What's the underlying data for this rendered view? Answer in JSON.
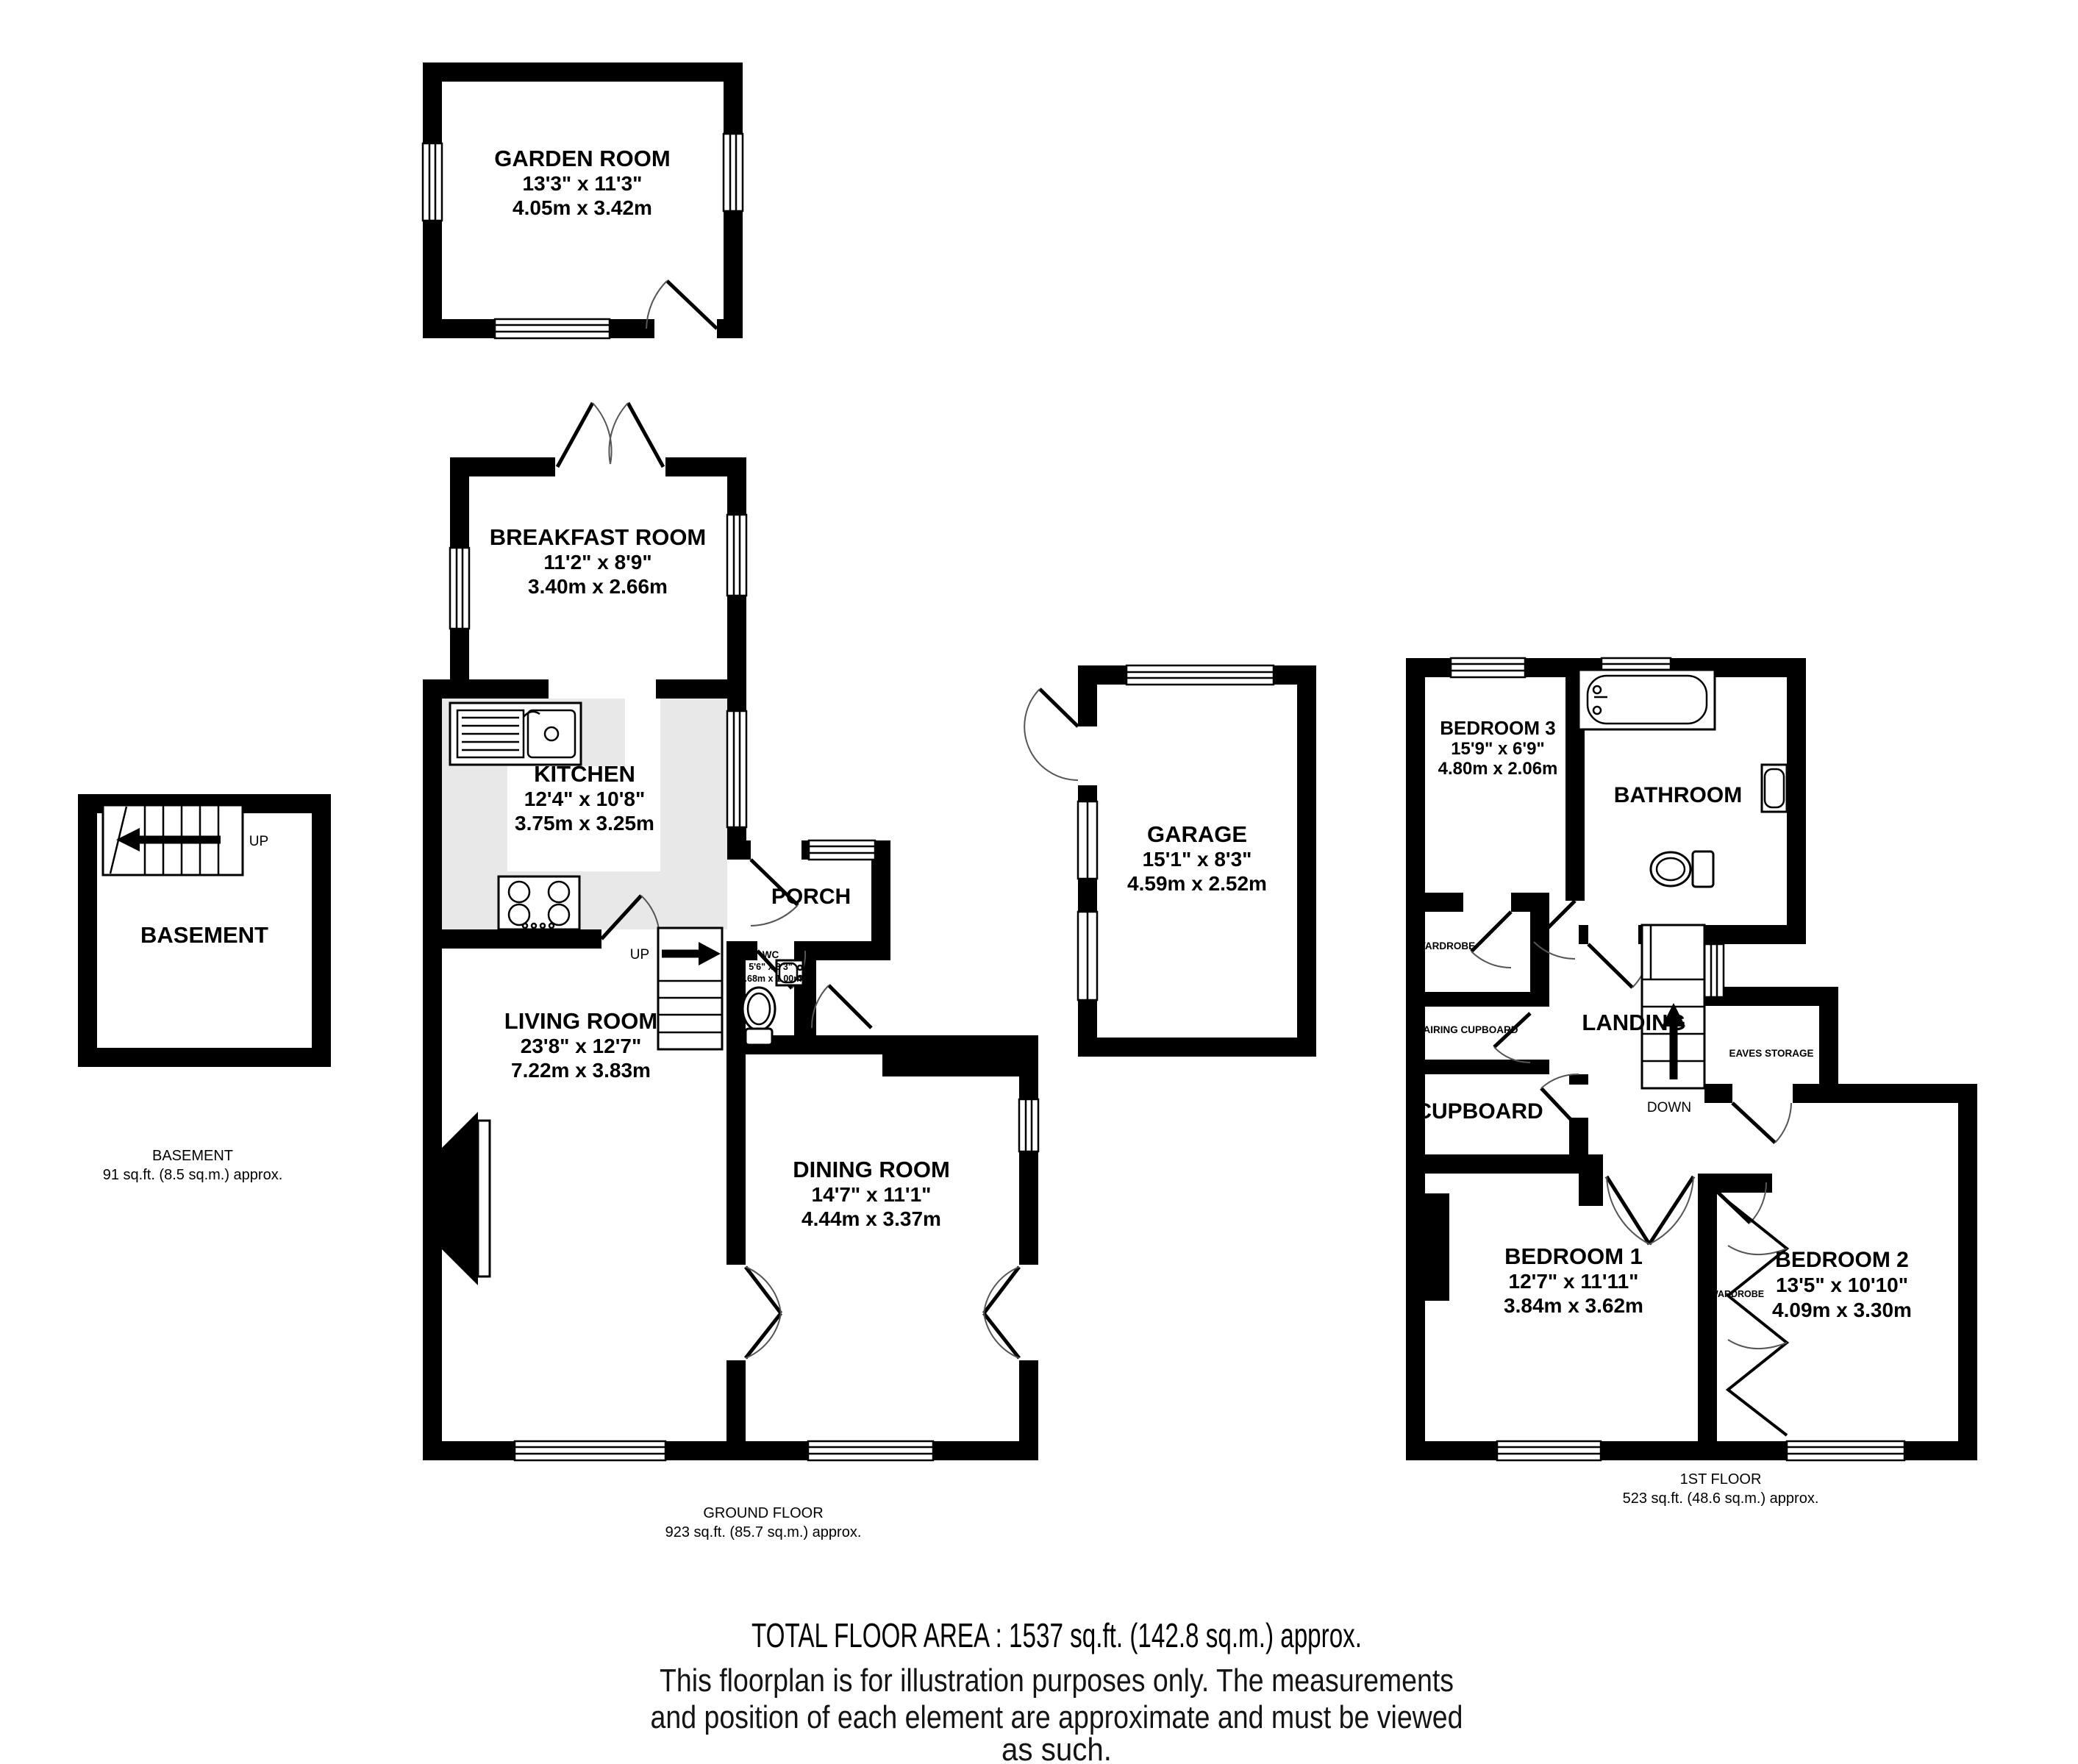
{
  "colors": {
    "wall": "#000000",
    "counter": "#e8e8e8",
    "background": "#ffffff"
  },
  "rooms": {
    "garden_room": {
      "name": "GARDEN ROOM",
      "imperial": "13'3\"  x 11'3\"",
      "metric": "4.05m  x 3.42m"
    },
    "breakfast_room": {
      "name": "BREAKFAST ROOM",
      "imperial": "11'2\"  x 8'9\"",
      "metric": "3.40m  x 2.66m"
    },
    "kitchen": {
      "name": "KITCHEN",
      "imperial": "12'4\"  x 10'8\"",
      "metric": "3.75m  x 3.25m"
    },
    "porch": {
      "name": "PORCH"
    },
    "wc": {
      "name": "WC",
      "imperial": "5'6\"  x 3'3\"",
      "metric": "1.68m  x 1.00m"
    },
    "living_room": {
      "name": "LIVING ROOM",
      "imperial": "23'8\"  x 12'7\"",
      "metric": "7.22m  x 3.83m"
    },
    "dining_room": {
      "name": "DINING ROOM",
      "imperial": "14'7\"  x 11'1\"",
      "metric": "4.44m  x 3.37m"
    },
    "garage": {
      "name": "GARAGE",
      "imperial": "15'1\"  x 8'3\"",
      "metric": "4.59m  x 2.52m"
    },
    "basement": {
      "name": "BASEMENT"
    },
    "bedroom1": {
      "name": "BEDROOM 1",
      "imperial": "12'7\"  x 11'11\"",
      "metric": "3.84m  x 3.62m"
    },
    "bedroom2": {
      "name": "BEDROOM 2",
      "imperial": "13'5\"  x 10'10\"",
      "metric": "4.09m  x 3.30m"
    },
    "bedroom3": {
      "name": "BEDROOM 3",
      "imperial": "15'9\"  x 6'9\"",
      "metric": "4.80m  x 2.06m"
    },
    "bathroom": {
      "name": "BATHROOM"
    },
    "landing": {
      "name": "LANDING"
    },
    "cupboard": {
      "name": "CUPBOARD"
    },
    "airing_cupboard": {
      "name": "AIRING CUPBOARD"
    },
    "wardrobe_bed3": {
      "name": "WARDROBE"
    },
    "wardrobe_bed2": {
      "name": "WARDROBE"
    },
    "eaves_storage": {
      "name": "EAVES STORAGE"
    }
  },
  "stairs": {
    "ground_up": "UP",
    "basement_up": "UP",
    "first_down": "DOWN"
  },
  "captions": {
    "ground": {
      "title": "GROUND FLOOR",
      "area": "923 sq.ft. (85.7 sq.m.) approx."
    },
    "basement": {
      "title": "BASEMENT",
      "area": "91 sq.ft. (8.5 sq.m.) approx."
    },
    "first": {
      "title": "1ST FLOOR",
      "area": "523 sq.ft. (48.6 sq.m.) approx."
    }
  },
  "footer": {
    "total": "TOTAL FLOOR AREA : 1537 sq.ft. (142.8 sq.m.) approx.",
    "disclaimer1": "This floorplan is for illustration purposes only. The measurements",
    "disclaimer2": "and position of each element are approximate and must be viewed",
    "disclaimer3": "as such."
  }
}
